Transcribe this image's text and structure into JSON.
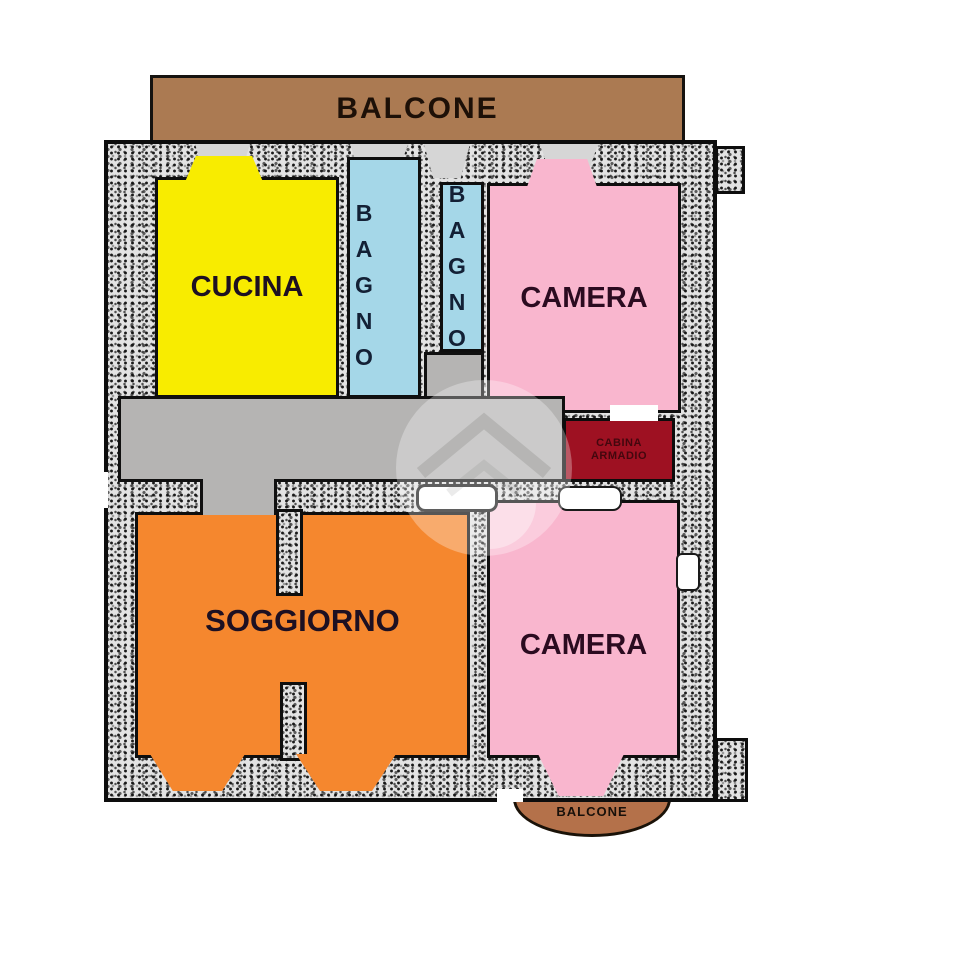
{
  "balcony_top": {
    "label": "BALCONE"
  },
  "rooms": {
    "cucina": {
      "label": "CUCINA"
    },
    "bagno1": {
      "label": "BAGNO"
    },
    "bagno2": {
      "label": "BAGNO"
    },
    "camera_top": {
      "label": "CAMERA"
    },
    "cabina_armadio": {
      "line1": "CABINA",
      "line2": "ARMADIO"
    },
    "soggiorno": {
      "label": "SOGGIORNO"
    },
    "camera_bottom": {
      "label": "CAMERA"
    }
  },
  "balcony_bottom": {
    "label": "BALCONE"
  },
  "colors": {
    "balcony_brown": "#ab7a52",
    "balcony_bottom_brown": "#b4714a",
    "kitchen_yellow": "#f8ec00",
    "bathroom_blue": "#a5d7e8",
    "bedroom_pink": "#f9b6ce",
    "closet_dark_red": "#9e1122",
    "living_orange": "#f5872e",
    "hallway_gray": "#b5b4b3",
    "wall_outline_black": "#0d0d0d",
    "wall_texture_gray": "#e3e3e3"
  }
}
